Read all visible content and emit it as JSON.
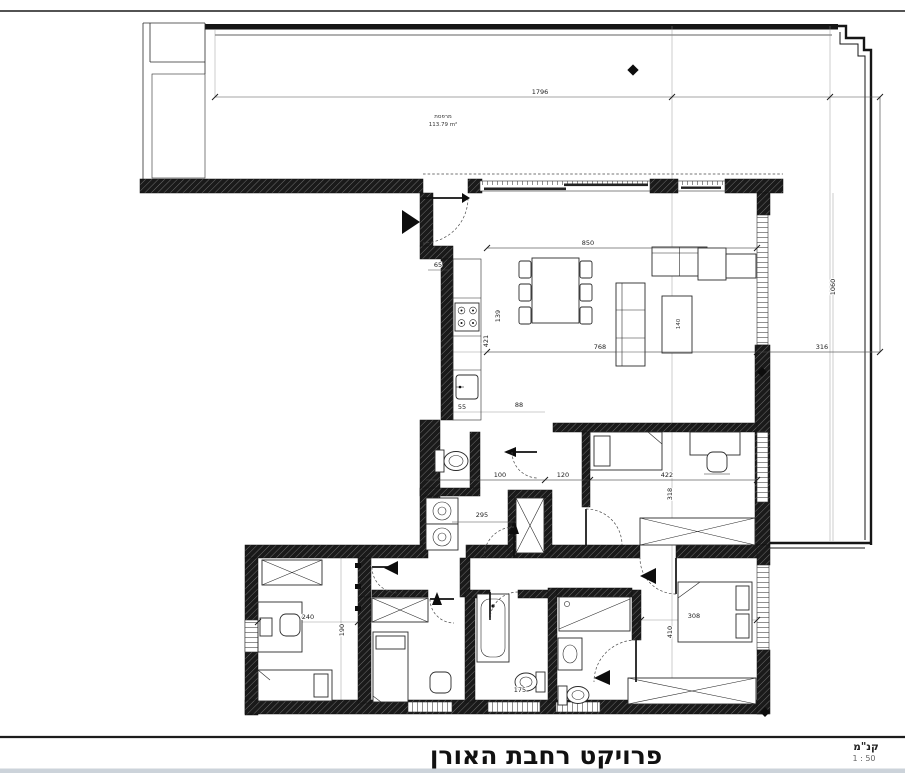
{
  "title_block": {
    "project_title": "פרויקט רחבת האורן",
    "scale_label": "קנ\"מ",
    "scale_value": "1 : 50"
  },
  "terrace": {
    "name_label": "מרפסת",
    "area_label": "113.79 m²"
  },
  "dimensions": {
    "terrace_width": "1796",
    "terrace_height": "1060",
    "terrace_side": "316",
    "living_width": "850",
    "living_depth": "768",
    "entry_niche": "65",
    "kitchen_len": "421",
    "kitchen_depth": "139",
    "wc_a": "55",
    "wc_b": "88",
    "hall_a": "100",
    "hall_b": "120",
    "bedroom1_width": "422",
    "bedroom1_depth": "318",
    "closet": "295",
    "bedroom2_width": "240",
    "bedroom2_depth": "190",
    "master_width": "308",
    "master_depth": "410",
    "bath": "175",
    "coffee_table": "140"
  },
  "colors": {
    "wall": "#161616",
    "accent_line": "#2b2b2b",
    "footer_strip": "#ccd3da"
  }
}
